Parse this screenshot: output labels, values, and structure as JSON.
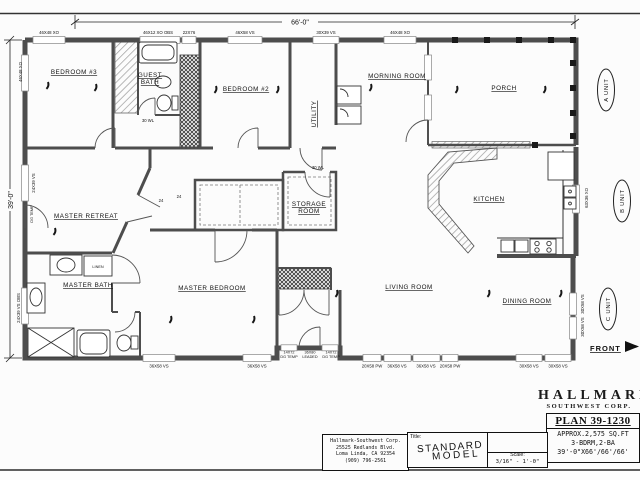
{
  "drawing": {
    "dim_width": "66'-0\"",
    "dim_height": "39'-0\"",
    "front_label": "FRONT"
  },
  "rooms": {
    "bedroom3": "BEDROOM #3",
    "guest_bath_line1": "GUEST",
    "guest_bath_line2": "BATH",
    "bedroom2": "BEDROOM #2",
    "utility": "UTILITY",
    "morning_room": "MORNING ROOM",
    "porch": "PORCH",
    "master_retreat": "MASTER RETREAT",
    "storage_line1": "STORAGE",
    "storage_line2": "ROOM",
    "linen": "LINEN",
    "master_bath": "MASTER BATH",
    "master_bedroom": "MASTER BEDROOM",
    "living_room": "LIVING ROOM",
    "kitchen": "KITCHEN",
    "dining_room": "DINING ROOM"
  },
  "windows": {
    "top": [
      "46X48 XO",
      "46X12 XO OBS",
      "22X76",
      "46X58 VS",
      "30X39 VS",
      "46X48 XO"
    ],
    "left": [
      "46X48 XO",
      "24X39 VS",
      "24X39 VS OBS"
    ],
    "left_note": "DG TEMP",
    "bottom": [
      "36X58 VS",
      "36X58 VS",
      "20X58 PW",
      "36X58 VS",
      "36X58 VS",
      "20X58 PW",
      "30X58 VS",
      "30X58 VS"
    ],
    "entry": [
      "14X72",
      "DG TEMP",
      "36X80",
      "LEADED",
      "14X72",
      "DG TEMP"
    ],
    "right": [
      "63X36 XO",
      "30X58 VS",
      "30X58 VS"
    ]
  },
  "door_labels": {
    "hall": "30 WL",
    "storage": "30 WL",
    "retreat_left": "24",
    "retreat_right": "24"
  },
  "unit_labels": {
    "a": "A UNIT",
    "b": "B UNIT",
    "c": "C UNIT"
  },
  "title_block": {
    "company_name": "HALLMARK",
    "company_subtitle": "SOUTHWEST CORP.",
    "plan_number": "PLAN 39-1230",
    "spec_sqft": "APPROX.2,575 SQ.FT",
    "spec_rooms": "3-BDRM,2-BA",
    "spec_dims": "39'-0\"X66'/66'/66'",
    "address_line1": "Hallmark-Southwest Corp.",
    "address_line2": "25525 Redlands Blvd.",
    "address_line3": "Loma Linda, CA 92354",
    "address_line4": "(909) 796-2561",
    "title_label": "Title:",
    "title_value_line1": "STANDARD",
    "title_value_line2": "MODEL",
    "scale_label": "Scale:",
    "scale_value": "3/16\" - 1'-0\""
  }
}
